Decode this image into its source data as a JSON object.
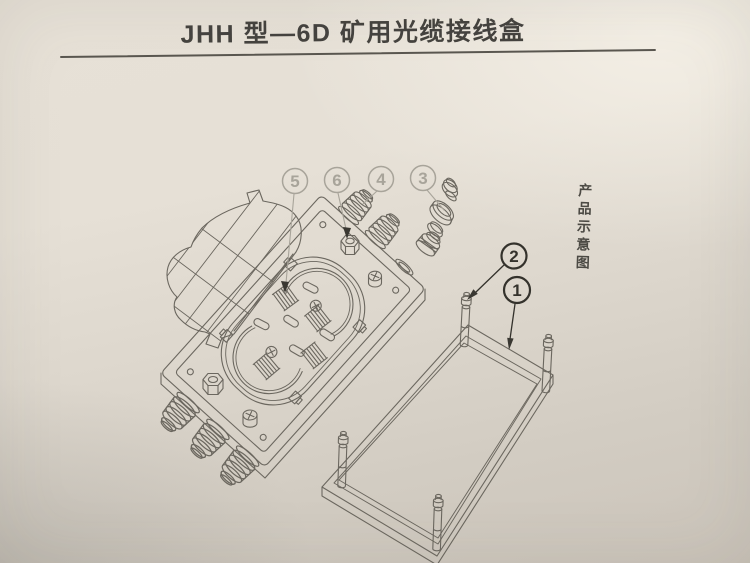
{
  "page": {
    "title": "JHH 型—6D 矿用光缆接线盒",
    "side_caption": "产品示意图"
  },
  "diagram": {
    "callouts": [
      {
        "num": "5",
        "style": "light"
      },
      {
        "num": "6",
        "style": "light"
      },
      {
        "num": "4",
        "style": "light"
      },
      {
        "num": "3",
        "style": "light"
      },
      {
        "num": "2",
        "style": "dark"
      },
      {
        "num": "1",
        "style": "dark"
      }
    ],
    "colors": {
      "paper_top": "#e7e1d7",
      "paper_bottom": "#cbc4ba",
      "line": "#6b675f",
      "callout_light": "#a8a49a",
      "callout_dark": "#34322c",
      "title_text": "#45433f"
    }
  }
}
